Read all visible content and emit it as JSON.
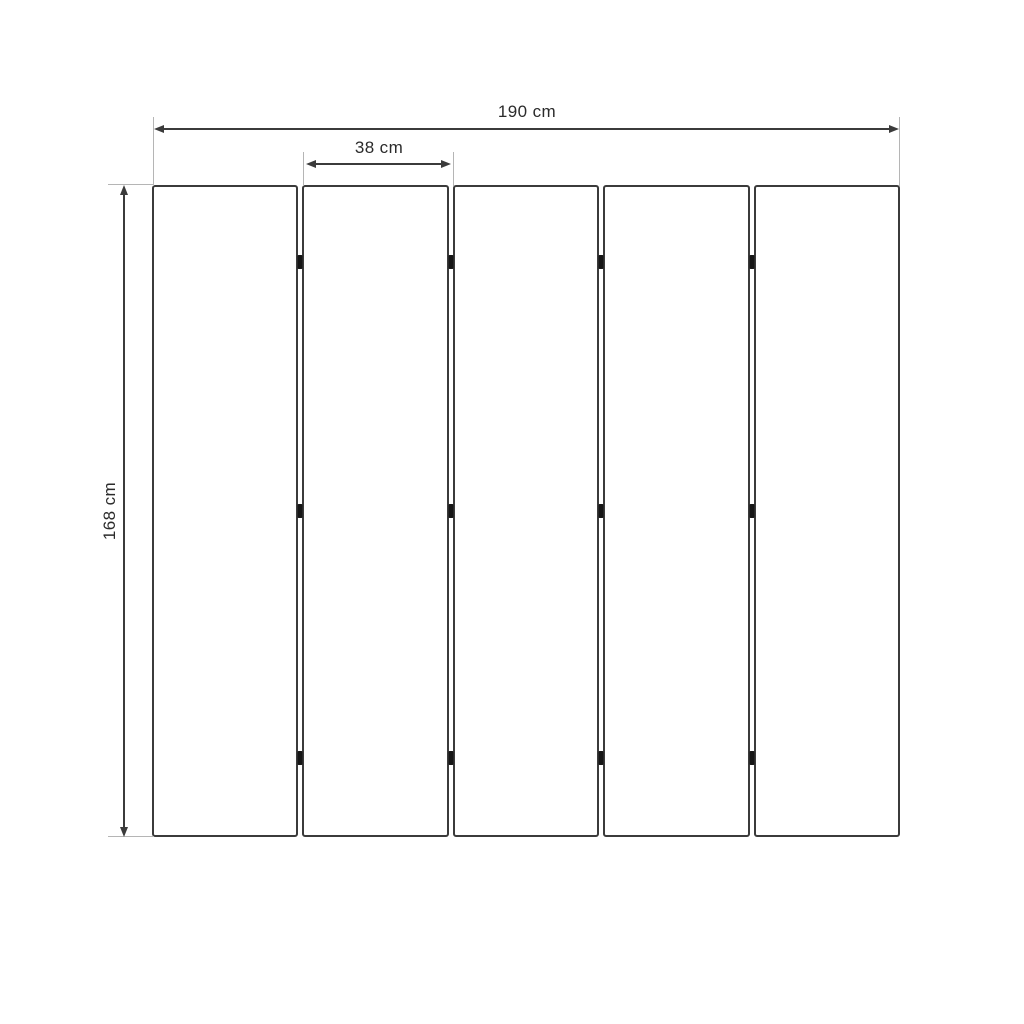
{
  "diagram": {
    "type": "dimension-drawing",
    "subject": "five-panel folding screen front view",
    "dimensions": {
      "total_width_label": "190 cm",
      "panel_width_label": "38 cm",
      "height_label": "168 cm"
    },
    "panels": {
      "count": 5,
      "junction_count": 4,
      "hinges_per_junction": 3
    },
    "colors": {
      "dimension_line": "#3b3b3b",
      "extension_line": "#b5b5b5",
      "panel_border": "#3b3b3b",
      "hinge": "#161616",
      "text": "#2b2b2b",
      "background": "#ffffff"
    }
  }
}
